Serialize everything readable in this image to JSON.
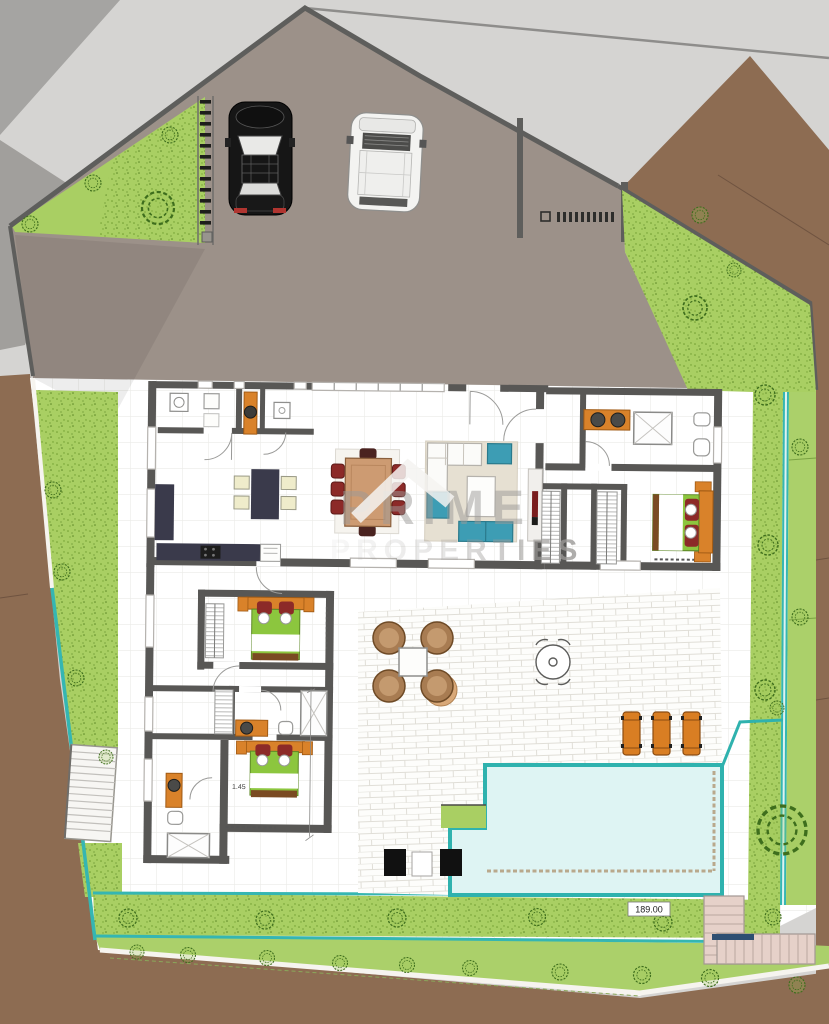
{
  "scene": {
    "description": "Colour architectural ground-floor site plan of a villa with driveway, two parked cars, perimeter gardens, terrace and swimming pool",
    "view": "top-down plan"
  },
  "watermark": {
    "line1": "PRIME",
    "line2": "PROPERTIES"
  },
  "labels": {
    "pool_area": "189.00",
    "bedroom_width": "1.45"
  },
  "palette": {
    "background": "#d5d4d2",
    "driveway": "#9c9189",
    "wall": "#585755",
    "grass": "#a9cf63",
    "grass_speckle": "#6f9c2e",
    "dirt_brown": "#8d6c52",
    "pool_water": "#def4f3",
    "pool_edge": "#2fb2ae",
    "accent_orange": "#d9822a",
    "bed_green": "#8cc63e",
    "pillow_red": "#8c2a28",
    "sofa_teal": "#3d9db4",
    "kitchen_navy": "#3a3a4b",
    "dining_wood": "#cd9b72",
    "rug_beige": "#e6e0d2",
    "stair_pink": "#e6d1c9"
  },
  "site": {
    "cars": [
      "black-sedan",
      "white-suv"
    ],
    "sun_loungers": 3,
    "gate_segments": 10,
    "fan_chairs": 4,
    "round_table_seats": 4,
    "pool_area_label": "189.00"
  },
  "house": {
    "bedrooms": 3,
    "bathrooms": 3,
    "kitchen_island_stools": 4,
    "dining_seats": 8,
    "walk_in_closets": 2
  }
}
